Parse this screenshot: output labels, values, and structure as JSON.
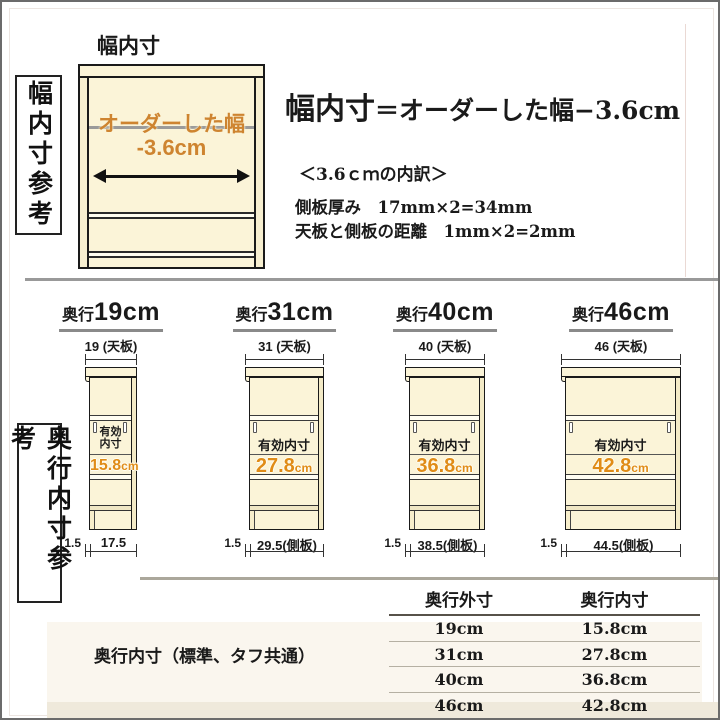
{
  "colors": {
    "accent_orange": "#d8891f",
    "cabinet_fill": "#fbf4d8",
    "separator_gray": "#999999"
  },
  "top_section": {
    "side_label": "幅内寸参考",
    "diagram": {
      "title": "幅内寸",
      "ordered_width_label": "オーダーした幅",
      "ordered_width_value": "-3.6cm"
    },
    "formula": {
      "lhs": "幅内寸",
      "eq": "＝",
      "rhs": "オーダーした幅−3.6cm"
    },
    "breakdown": {
      "heading": "＜3.6ｃｍの内訳＞",
      "line1": "側板厚み　17mm×2=34mm",
      "line2": "天板と側板の距離　1mm×2=2mm"
    }
  },
  "depth_section": {
    "side_label": "奥行内寸参考",
    "cabinets": [
      {
        "title_prefix": "奥行",
        "title_size": "19cm",
        "top_board_label": "19 (天板)",
        "inner_label": "有効\n内寸",
        "inner_value": "15.8",
        "inner_unit": "cm",
        "front_gap": "1.5",
        "depth_label": "17.5"
      },
      {
        "title_prefix": "奥行",
        "title_size": "31cm",
        "top_board_label": "31 (天板)",
        "inner_label": "有効内寸",
        "inner_value": "27.8",
        "inner_unit": "cm",
        "front_gap": "1.5",
        "depth_label": "29.5(側板)"
      },
      {
        "title_prefix": "奥行",
        "title_size": "40cm",
        "top_board_label": "40 (天板)",
        "inner_label": "有効内寸",
        "inner_value": "36.8",
        "inner_unit": "cm",
        "front_gap": "1.5",
        "depth_label": "38.5(側板)"
      },
      {
        "title_prefix": "奥行",
        "title_size": "46cm",
        "top_board_label": "46 (天板)",
        "inner_label": "有効内寸",
        "inner_value": "42.8",
        "inner_unit": "cm",
        "front_gap": "1.5",
        "depth_label": "44.5(側板)"
      }
    ],
    "caption": "奥行内寸（標準、タフ共通）",
    "table": {
      "headers": [
        "奥行外寸",
        "奥行内寸"
      ],
      "rows": [
        [
          "19cm",
          "15.8cm"
        ],
        [
          "31cm",
          "27.8cm"
        ],
        [
          "40cm",
          "36.8cm"
        ],
        [
          "46cm",
          "42.8cm"
        ]
      ]
    }
  }
}
